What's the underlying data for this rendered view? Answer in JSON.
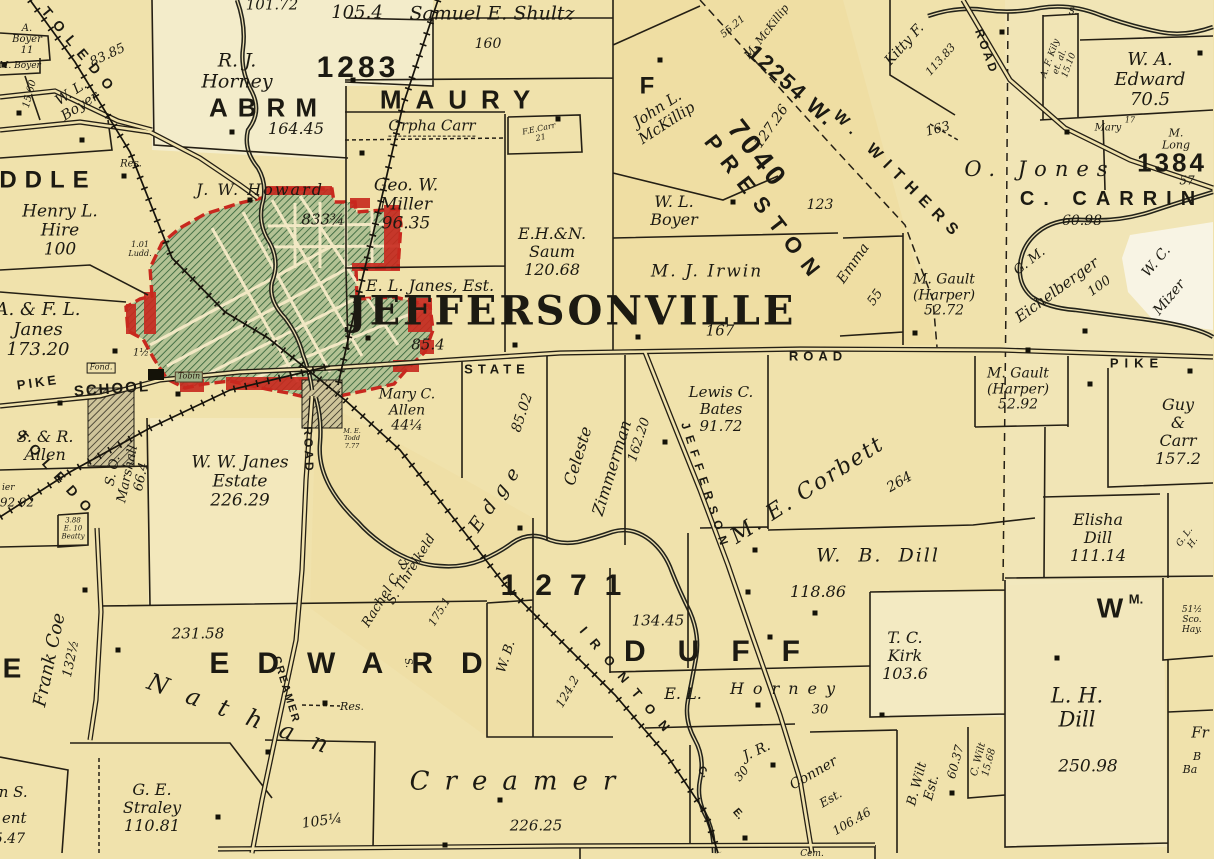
{
  "map": {
    "place_title": "JEFFERSONVILLE",
    "district_numbers": [
      "1283",
      "7040",
      "12254",
      "1384",
      "1271"
    ]
  },
  "colors": {
    "paper": "#f0e2ac",
    "ink": "#1c1a12",
    "town_fill": "#b3c294",
    "town_hatch_green": "#34633a",
    "town_border_red": "#c8281e",
    "creek": "#23231a"
  },
  "labels": {
    "toledo1": "TOLEDO",
    "toledo2": "TOLEDO",
    "boyer_a": "A.\nBoyer\n11",
    "boyer_m": "M. Boyer",
    "n1560": "15.60",
    "boyer_wl1": "W. L.\nBoyer",
    "n8385": "83.85",
    "ddle": "DDLE",
    "hire": "Henry L.\nHire\n100",
    "res1": "Res.",
    "n1054": "105.4",
    "n10172": "101.72",
    "n1283": "1283",
    "horney_rj": "R. J.\nHorney",
    "abrm": "ABRM",
    "n16445": "164.45",
    "howard": "J. W. Howard",
    "n833": "833¾",
    "ludd": "1.01\nLudd.",
    "n1h": "1½",
    "maury": "MAURY",
    "shultz": "Samuel E. Shultz",
    "n160": "160",
    "orpha": "Orpha Carr",
    "carr_fe": "F.E.Carr\n21",
    "miller": "Geo. W.\nMiller\n96.35",
    "saum": "E.H.&N.\nSaum\n120.68",
    "janes_el": "E. L. Janes, Est.",
    "title": "JEFFERSONVILLE",
    "n854": "85.4",
    "irwin": "M. J. Irwin",
    "n167": "167",
    "state": "STATE",
    "road1": "ROAD",
    "school": "SCHOOL",
    "pike_w": "PIKE",
    "fond": "Fond.",
    "tobin": "Tobin",
    "janes_afl": "A. & F. L.\nJanes\n173.20",
    "allen_sr": "S. & R.\nAllen",
    "ier": "ier",
    "n9292": "92.92",
    "marshall": "S. O.\nMarshall\n66.4",
    "janes_ww": "W. W. Janes\nEstate\n226.29",
    "road2": "ROAD",
    "creamer_rd": "CREAMER",
    "beatty": "3.88\nE. 10\nBeatty",
    "allen_mc": "Mary C.\nAllen\n44¼",
    "todd": "M. E.\nTodd\n7.77",
    "rachel": "Rachel C. &",
    "threlkeld": "S. Threlkeld",
    "n1751": "175.1",
    "edge": "Edge",
    "n8502": "85.02",
    "celeste": "Celeste",
    "zimmerman": "Zimmerman",
    "n16220": "162.20",
    "jefferson_rd": "JEFFERSON",
    "bates": "Lewis C.\nBates\n91.72",
    "corbett": "M. E. Corbett",
    "n264": "264",
    "wb_dill": "W.  B.  Dill",
    "n11886": "118.86",
    "n1271": "1271",
    "n13445": "134.45",
    "duff": "DUFF",
    "edward": "EDWARD",
    "s_rot": "S.",
    "horney_el": "E. L.",
    "horney2": "Horney",
    "n30a": "30",
    "ironton": "IRONTON",
    "ir_c": "C.",
    "ir_e": "E.",
    "n30b": "30",
    "jr": "J. R.",
    "conner": "Conner",
    "est": "Est.",
    "n10646": "106.46",
    "wb2": "W. B.",
    "n1242": "124.2",
    "nathan": "Nathan",
    "n23158": "231.58",
    "creamer_nm": "Creamer",
    "n22625": "226.25",
    "res2": "Res.",
    "n105q": "105¼",
    "coe": "Frank Coe",
    "n132h": "132½",
    "bigE": "E",
    "straley": "G. E.\nStraley\n110.81",
    "johns": "John S.",
    "ent": "ent",
    "n10547": "105.47",
    "kirk": "T. C.\nKirk\n103.6",
    "lh_dill": "L. H.\nDill",
    "n25098": "250.98",
    "wm": "W",
    "wm_m": "M.",
    "box51": "51½\nSco.\nHay.",
    "bwilt": "B. Wilt\nEst.",
    "n6037": "60.37",
    "cwilt": "C. Wilt\n15.68",
    "fr": "Fr",
    "fr_b": "B",
    "fr_ba": "Ba",
    "elisha": "Elisha\nDill\n111.14",
    "glh": "G. L. H.",
    "guy": "Guy &\nCarr\n157.2",
    "pike_e": "PIKE",
    "gault1": "M. Gault\n(Harper)\n52.72",
    "gault2": "M. Gault\n(Harper)\n52.92",
    "emma": "Emma",
    "n55": "55",
    "withers": "W. WITHERS",
    "n12254": "12254 W.",
    "n5521": "55.21",
    "mckillip_m": "M. McKillip",
    "kitty": "Kitty F.",
    "n11383": "113.83",
    "road3": "ROAD",
    "kily": "A. F. Kily\net. al.\n15.10",
    "edward_wa": "W. A.\nEdward\n70.5",
    "n163": "163",
    "mary": "Mary",
    "n17": "17",
    "mlong": "M. Long",
    "n1384": "1384",
    "n57": "57",
    "ojones": "O. Jones",
    "carrington": "C. CARRIN",
    "n6098": "60.98",
    "gm": "G. M.",
    "eichel": "Eichelberger",
    "n100": "100",
    "wc": "W. C.",
    "mizer": "Mizer",
    "boyer_wl2": "W. L.\nBoyer",
    "n123": "123",
    "mckillip_j": "John L.\nMcKillip",
    "n12726": "127.26",
    "n7040": "7040",
    "f_big": "F",
    "preston": "PRESTON",
    "cem": "Cem.",
    "s_top": "S."
  }
}
